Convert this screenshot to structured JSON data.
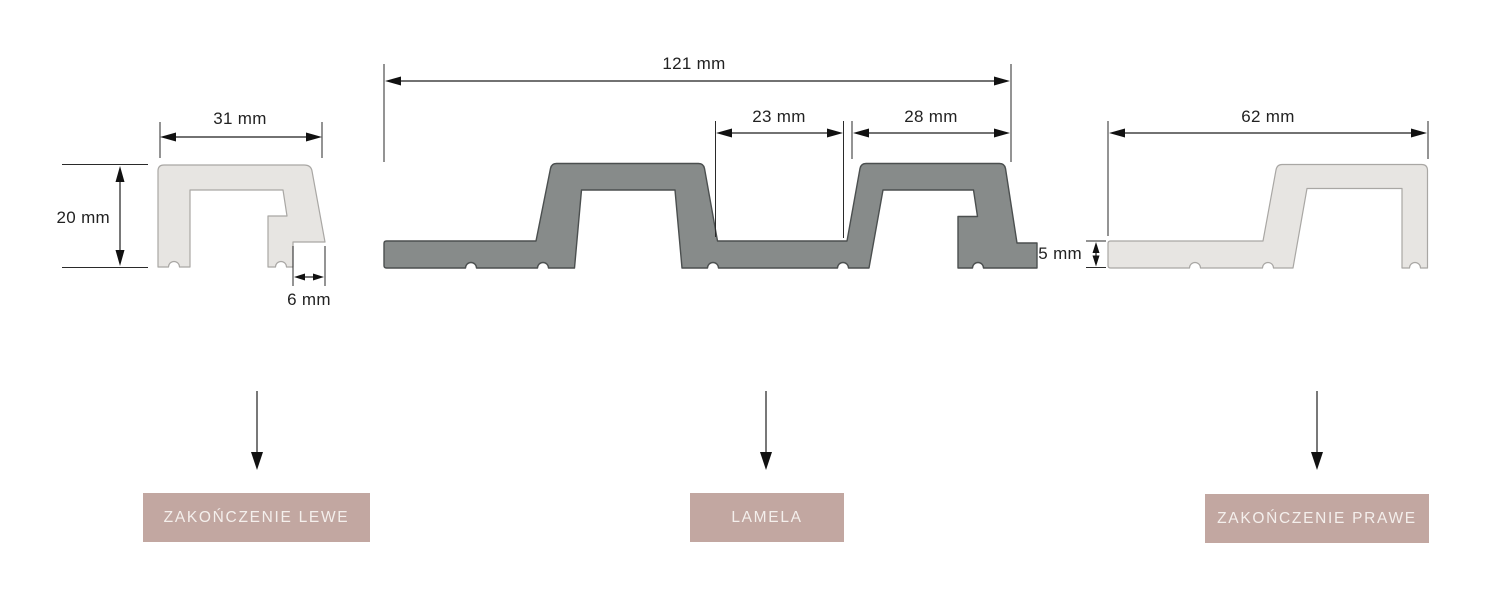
{
  "diagram": {
    "title_implied": "",
    "dimensions": {
      "left_width": "31 mm",
      "left_height": "20 mm",
      "left_notch": "6 mm",
      "lamela_width": "121 mm",
      "lamela_groove": "23 mm",
      "lamela_ridge": "28 mm",
      "right_width": "62 mm",
      "right_thickness": "5 mm"
    },
    "labels": {
      "left": "ZAKOŃCZENIE LEWE",
      "middle": "LAMELA",
      "right": "ZAKOŃCZENIE PRAWE"
    },
    "colors": {
      "profile_light_fill": "#e7e5e2",
      "profile_light_stroke": "#a9a7a4",
      "profile_dark_fill": "#878b8a",
      "profile_dark_stroke": "#4b4f4f",
      "dimension_line": "#1e1e1e",
      "label_background": "#c2a7a1",
      "label_text": "#f4efec"
    }
  }
}
